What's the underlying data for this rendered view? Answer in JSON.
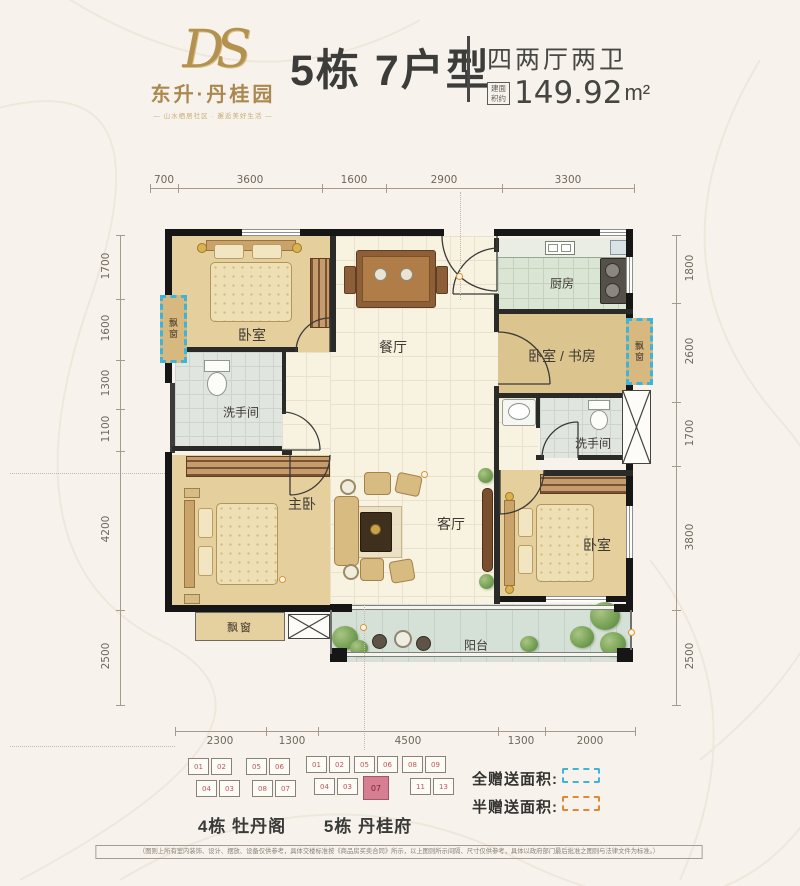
{
  "header": {
    "logo_monogram": "DS",
    "brand": "东升·丹桂园",
    "tagline": "— 山水栖居社区 · 邂逅美好生活 —",
    "title": "5栋 7户型",
    "spec": "四两厅两卫",
    "area_label_line1": "建面",
    "area_label_line2": "积约",
    "area_value": "149.92",
    "area_unit": "m²"
  },
  "plan": {
    "dims_top": [
      "700",
      "3600",
      "1600",
      "2900",
      "3300"
    ],
    "dims_left": [
      "1700",
      "1600",
      "1300",
      "1100",
      "4200",
      "2500"
    ],
    "dims_right": [
      "1800",
      "2600",
      "1700",
      "3800",
      "2500"
    ],
    "dims_bottom": [
      "2300",
      "1300",
      "4500",
      "1300",
      "2000"
    ],
    "rooms": {
      "bedroom_tl": "卧室",
      "dining": "餐厅",
      "kitchen": "厨房",
      "study": "卧室 / 书房",
      "bath_left": "洗手间",
      "bath_right": "洗手间",
      "master": "主卧",
      "living": "客厅",
      "bedroom_br": "卧室",
      "balcony": "阳台",
      "bay_left": "飘窗",
      "bay_right": "飘窗",
      "bay_bottom": "飘窗"
    }
  },
  "footer": {
    "building4": {
      "name": "4栋 牡丹阁",
      "units_top": [
        "01",
        "02",
        "05",
        "06"
      ],
      "units_bottom": [
        "04",
        "03",
        "08",
        "07"
      ]
    },
    "building5": {
      "name": "5栋 丹桂府",
      "units_top": [
        "01",
        "02",
        "05",
        "06",
        "08",
        "09"
      ],
      "units_bottom": [
        "04",
        "03",
        "07",
        "11",
        "13"
      ],
      "highlighted_unit": "07"
    },
    "legend": [
      {
        "label": "全赠送面积:",
        "color": "#3fb4da"
      },
      {
        "label": "半赠送面积:",
        "color": "#dd8a33"
      }
    ],
    "disclaimer": "（图则上所有室内装饰、设计、摆放、设备仅供参考，具体交楼标准按《商品房买卖合同》所示，以上图则所示间隔、尺寸仅供参考，具体以政府部门最后批准之图则与法律文件为标准。）"
  },
  "colors": {
    "gold": "#b3924f",
    "full_gift_dash": "#3fb4da",
    "half_gift_dash": "#dd8a33",
    "unit_highlight": "#d77e92",
    "wall": "#161616",
    "background": "#f7f3ec"
  }
}
